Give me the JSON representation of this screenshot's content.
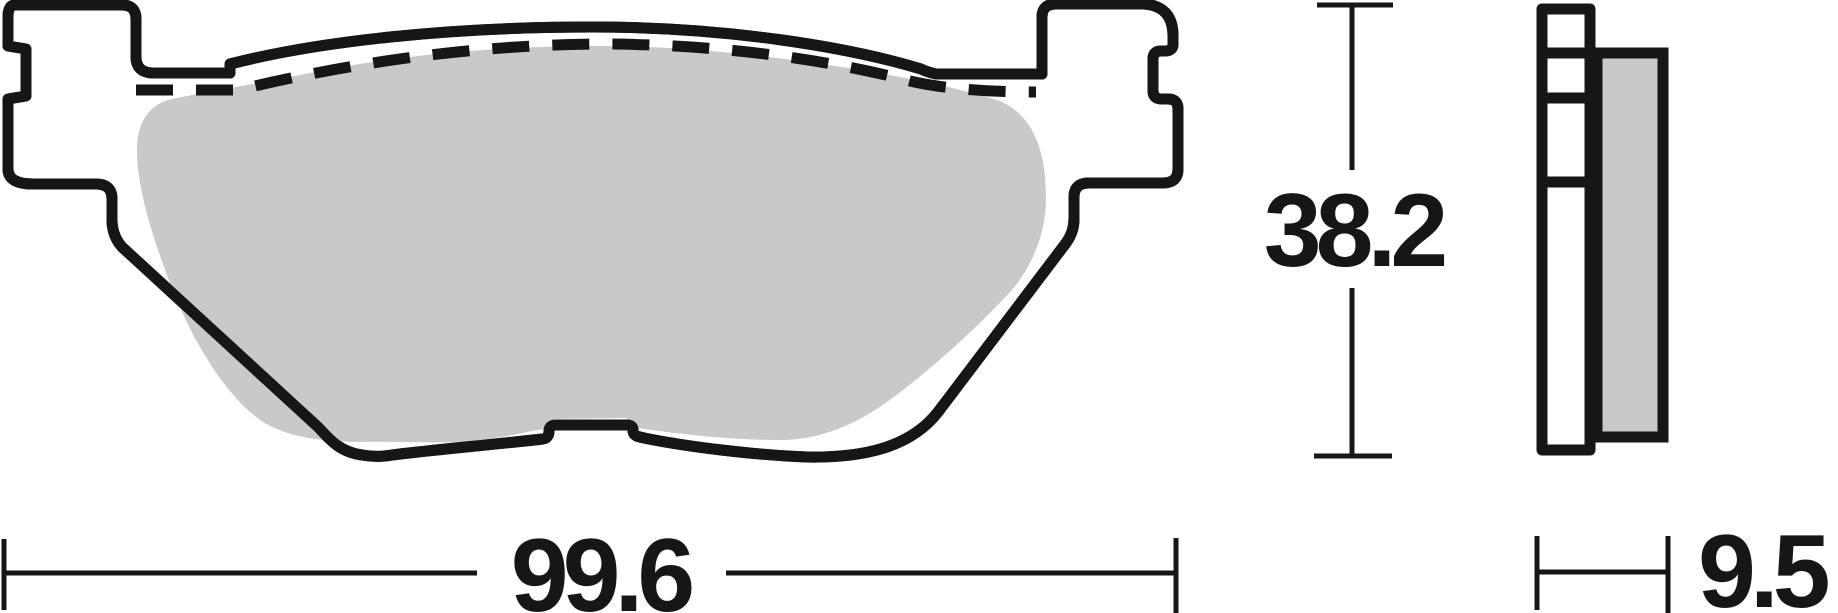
{
  "drawing": {
    "kind": "brake-pad-technical-drawing",
    "dimension_labels": {
      "length": "99.6",
      "height": "38.2",
      "thickness": "9.5"
    },
    "colors": {
      "line": "#161616",
      "pad_fill": "#c9c9c9",
      "plate_fill": "#ffffff",
      "background": "#ffffff"
    }
  }
}
